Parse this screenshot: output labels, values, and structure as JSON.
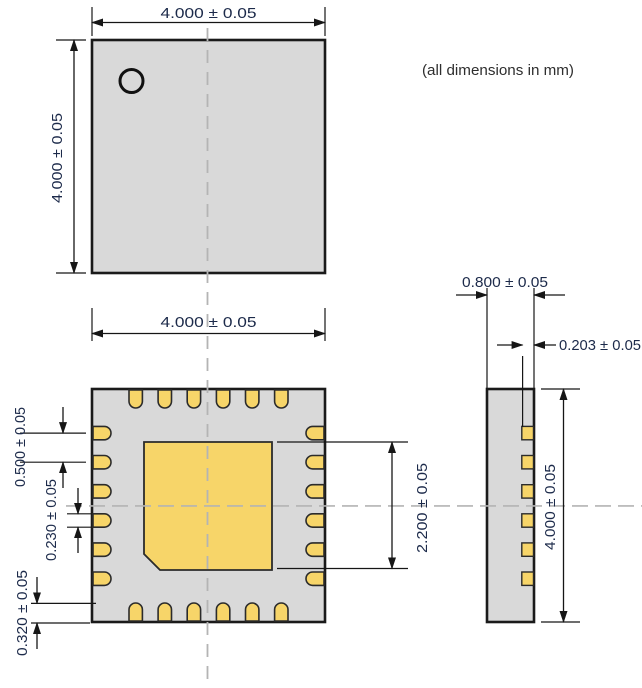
{
  "note": "(all dimensions in mm)",
  "colors": {
    "body": "#d9d9d9",
    "pad": "#f7d569",
    "outline": "#1a1a1a",
    "line": "#161616",
    "dim_text": "#1c2a4a",
    "note_text": "#2e2e2e",
    "centerline": "#b4b4b4"
  },
  "top_view": {
    "width": "4.000 ± 0.05",
    "height": "4.000 ± 0.05"
  },
  "bottom_view": {
    "width": "4.000 ± 0.05",
    "pad_pitch": "0.500 ± 0.05",
    "pad_width": "0.230 ± 0.05",
    "pad_length": "0.320 ± 0.05",
    "center_pad_size": "2.200 ± 0.05"
  },
  "side_view": {
    "thickness": "0.800 ± 0.05",
    "lead_thickness": "0.203 ± 0.05",
    "height": "4.000 ± 0.05"
  }
}
